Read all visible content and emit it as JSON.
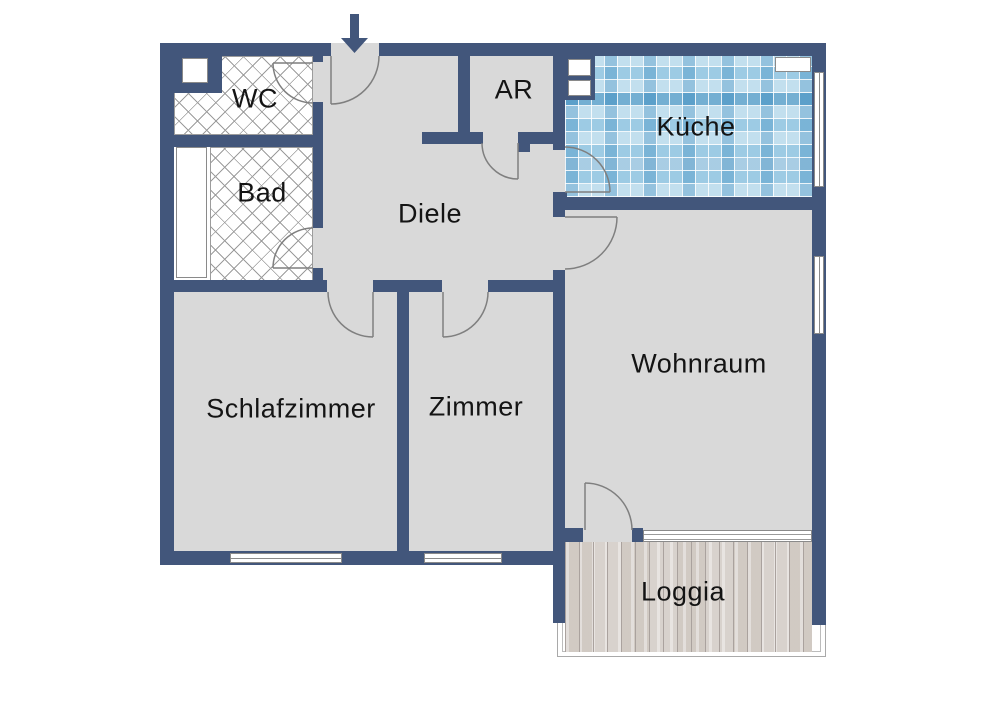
{
  "plan": {
    "title": "Apartment floor plan",
    "rooms": [
      {
        "id": "wc",
        "label": "WC"
      },
      {
        "id": "bad",
        "label": "Bad"
      },
      {
        "id": "diele",
        "label": "Diele"
      },
      {
        "id": "ar",
        "label": "AR"
      },
      {
        "id": "kueche",
        "label": "Küche"
      },
      {
        "id": "schlafzimmer",
        "label": "Schlafzimmer"
      },
      {
        "id": "zimmer",
        "label": "Zimmer"
      },
      {
        "id": "wohnraum",
        "label": "Wohnraum"
      },
      {
        "id": "loggia",
        "label": "Loggia"
      }
    ],
    "icons": {
      "entrance_arrow": "arrow-down"
    },
    "colors": {
      "wall": "#42567b",
      "floor": "#d9d9d9",
      "tile_base": "#9dcbe4",
      "wood_base": "#d8d2cd",
      "door_arc": "#7f7f7f",
      "window": "#ffffff"
    }
  }
}
